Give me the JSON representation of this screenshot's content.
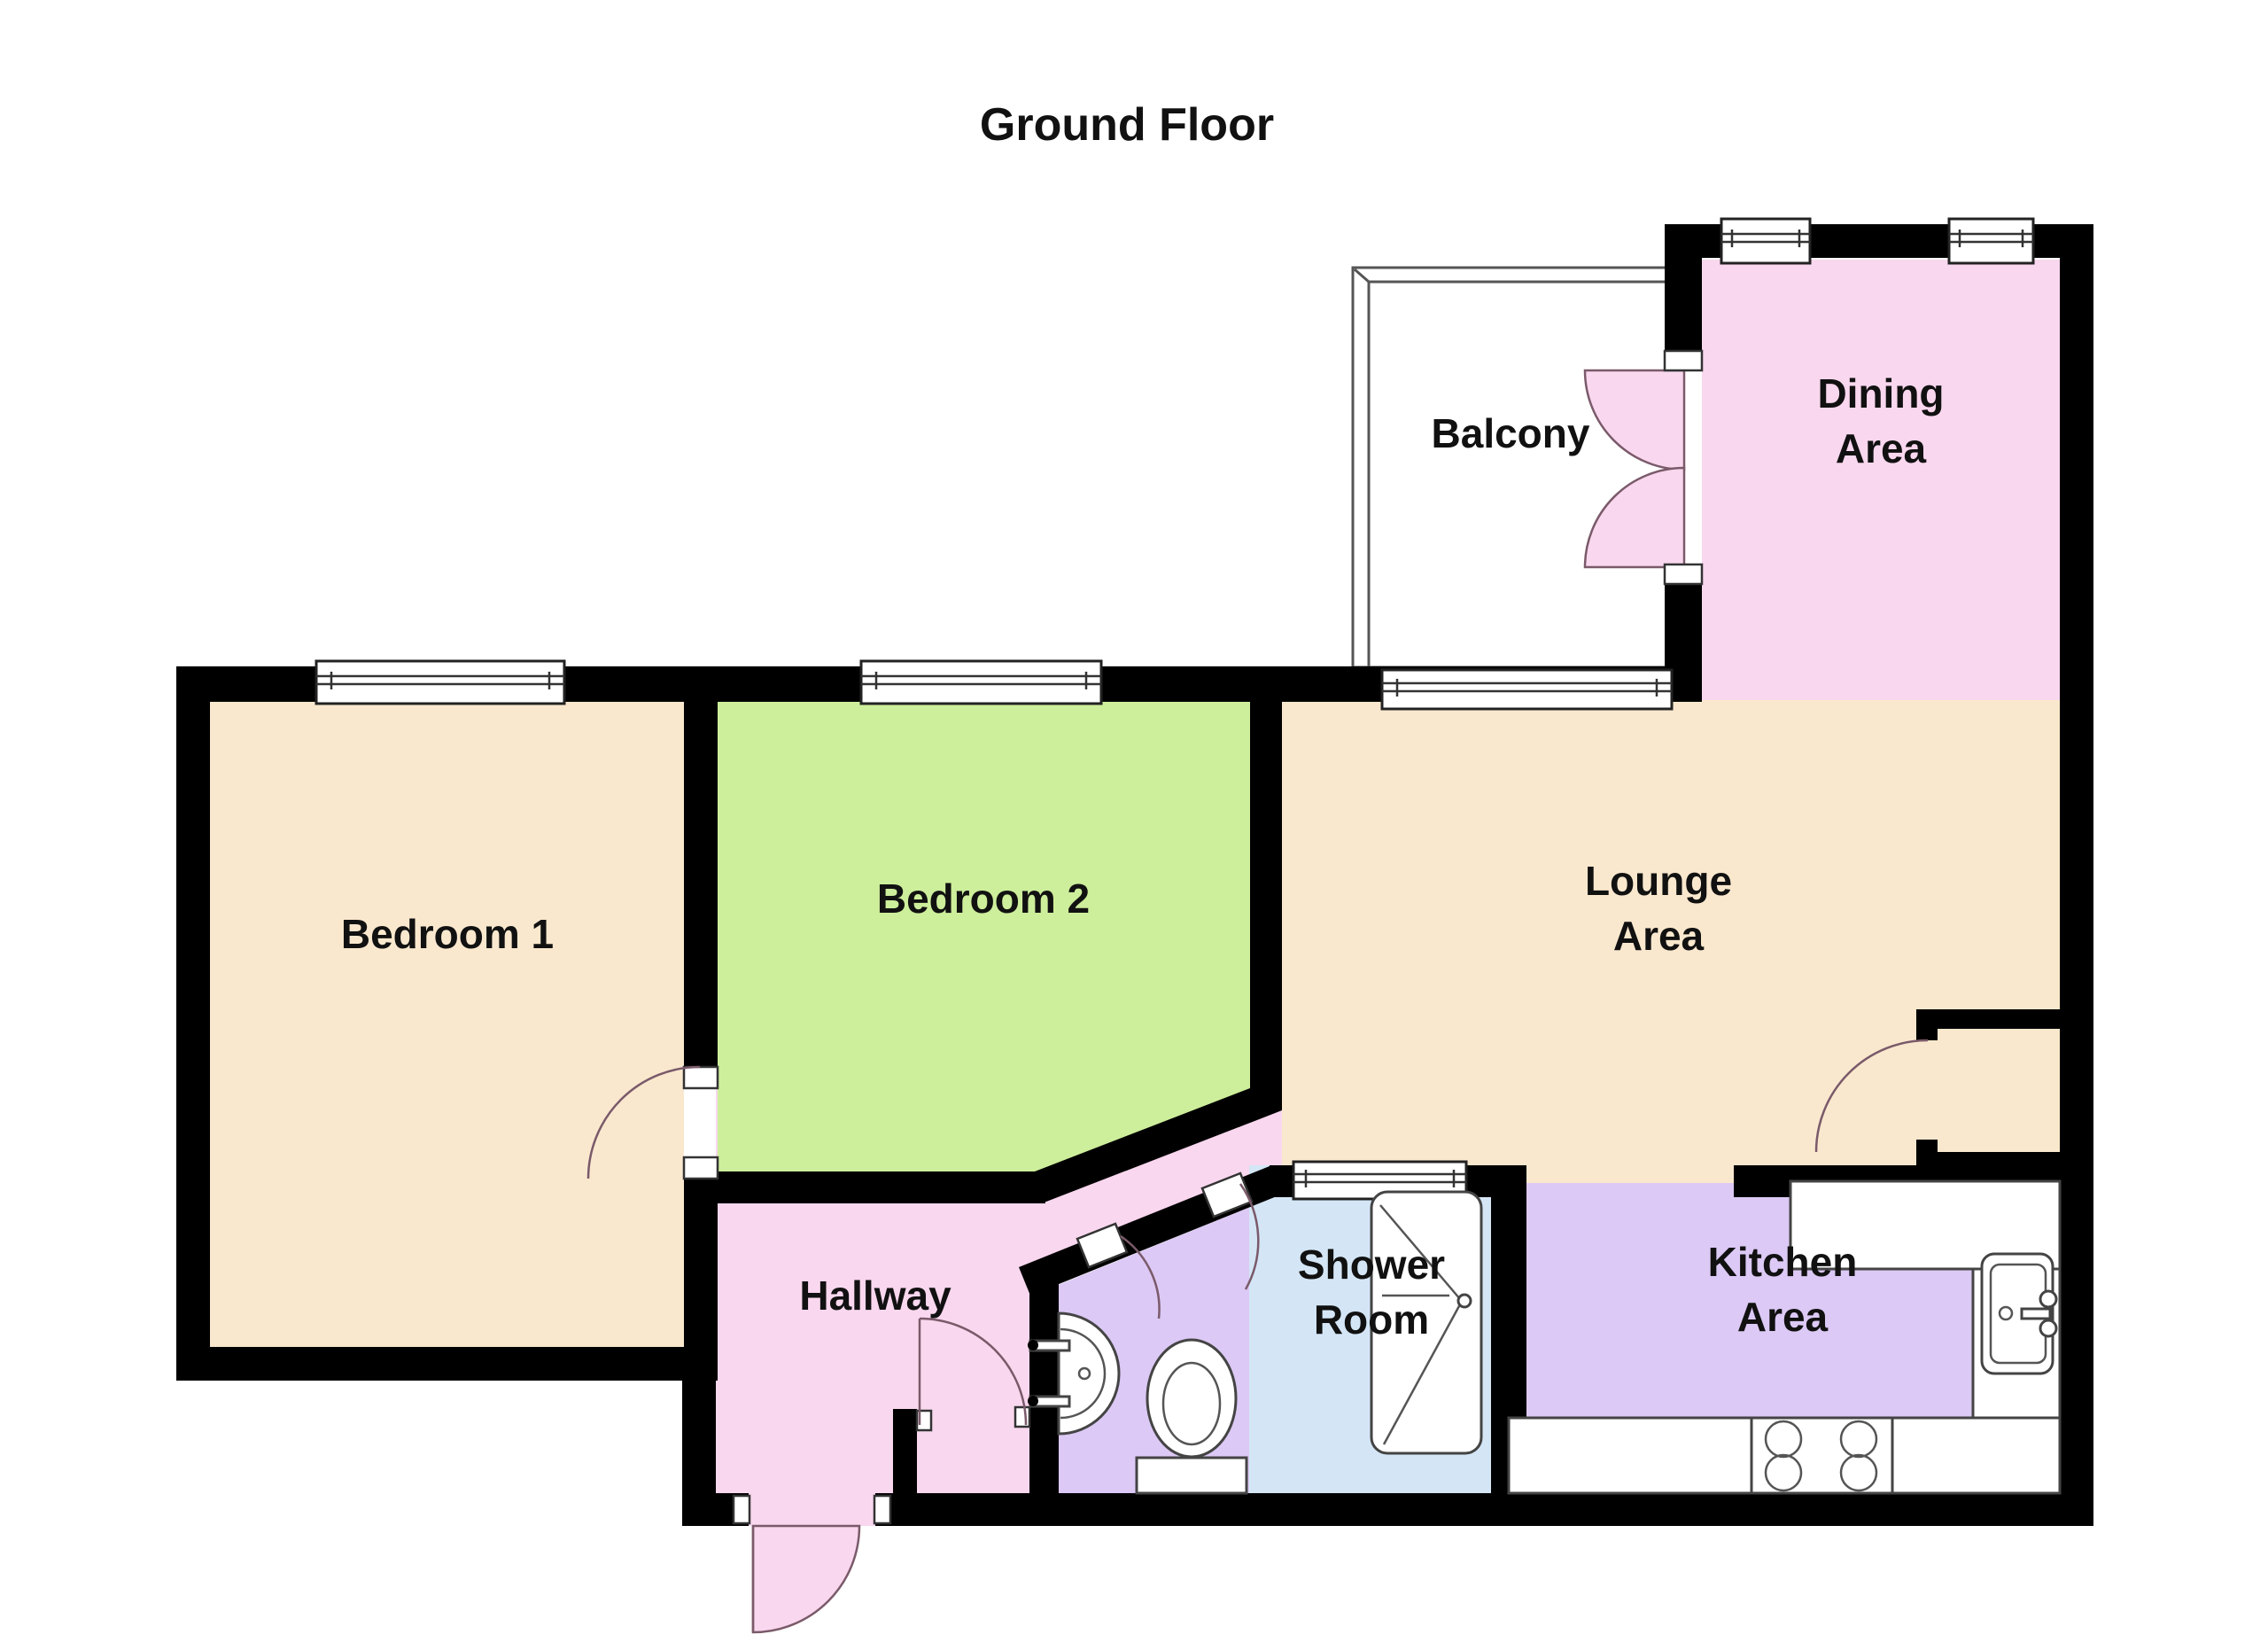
{
  "title": "Ground Floor",
  "rooms": {
    "bedroom1": {
      "label": "Bedroom 1"
    },
    "bedroom2": {
      "label": "Bedroom 2"
    },
    "lounge": {
      "line1": "Lounge",
      "line2": "Area"
    },
    "dining": {
      "line1": "Dining",
      "line2": "Area"
    },
    "balcony": {
      "label": "Balcony"
    },
    "hallway": {
      "label": "Hallway"
    },
    "shower": {
      "line1": "Shower",
      "line2": "Room"
    },
    "kitchen": {
      "line1": "Kitchen",
      "line2": "Area"
    }
  },
  "colors": {
    "wall": "#000000",
    "bedroom1_floor": "#FAE8CE",
    "bedroom2_floor": "#CDEE9B",
    "lounge_floor": "#FAE8CE",
    "dining_floor": "#F9D7EE",
    "hallway_floor": "#F9D7EE",
    "wc_floor": "#DCC9F5",
    "kitchen_floor": "#DCC9F5",
    "shower_floor": "#D4E6F6",
    "outline": "#555555"
  }
}
